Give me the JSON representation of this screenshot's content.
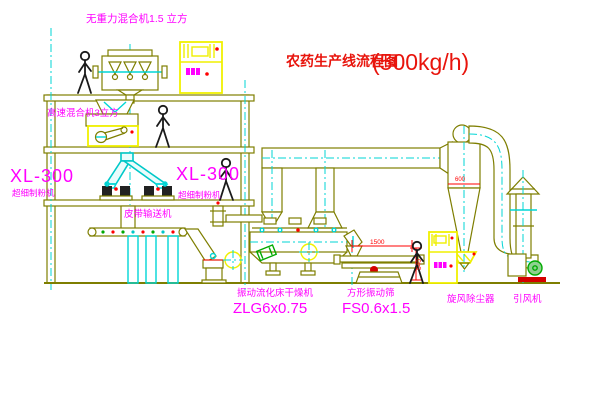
{
  "diagram": {
    "title": {
      "name": "农药生产线流程图",
      "capacity": "(500kg/h)"
    },
    "equipment_labels": {
      "gravity_mixer": "无重力混合机1.5 立方",
      "high_speed_mixer": "高速混合机3立方",
      "left_mill_model": "XL-300",
      "left_mill_name": "超细制粉机",
      "center_mill_model": "XL-300",
      "center_mill_name": "超细制粉机",
      "belt_conveyor": "皮带输送机",
      "fluid_bed_dryer_name": "振动流化床干燥机",
      "fluid_bed_dryer_model": "ZLG6x0.75",
      "vibrating_screen_name": "方形振动筛",
      "vibrating_screen_model": "FS0.6x1.5",
      "cyclone_dust_collector": "旋风除尘器",
      "induced_draft_fan": "引风机"
    },
    "dimensions": {
      "screen_length": "1500",
      "screen_height": "540",
      "cyclone_diameter": "600"
    },
    "colors": {
      "line_olive": "#7e7e00",
      "accent_cyan": "#00d5d5",
      "cabinet_yellow": "#f0f000",
      "label_magenta": "#ff00ff",
      "title_red": "#e8140c",
      "dimension_red": "#ff0000",
      "motor_green": "#00aa00",
      "background": "#ffffff"
    }
  }
}
